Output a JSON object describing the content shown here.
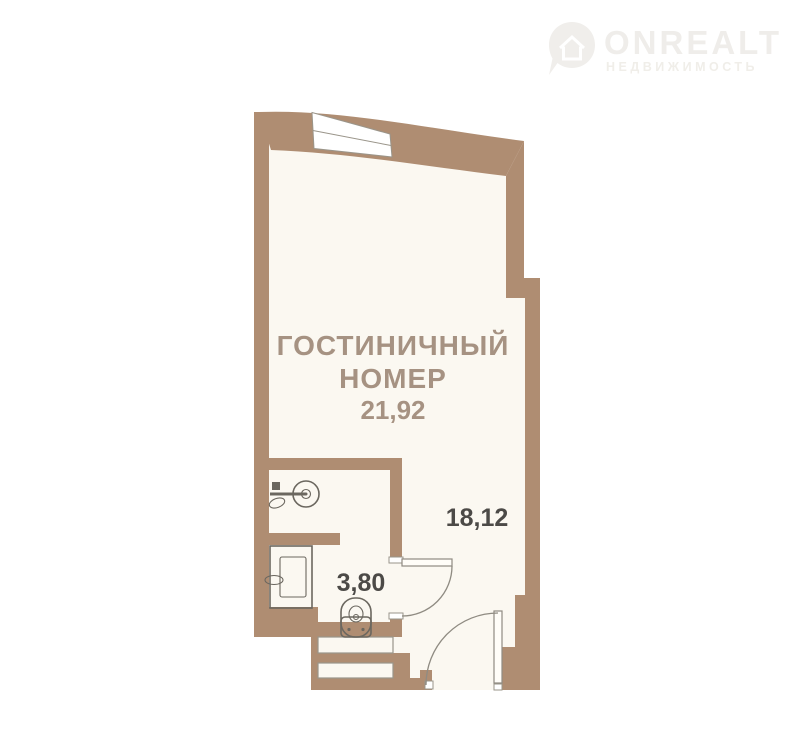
{
  "watermark": {
    "brand": "ONREALT",
    "subtitle": "НЕДВИЖИМОСТЬ",
    "icon": "onrealt-pin-house-icon"
  },
  "plan": {
    "room_label_line1": "ГОСТИНИЧНЫЙ",
    "room_label_line2": "НОМЕР",
    "room_total_area": "21,92",
    "main_room_area": "18,12",
    "bathroom_area": "3,80",
    "colors": {
      "wall": "#af8d72",
      "floor": "#fbf8f1",
      "room_label_text": "#a69282",
      "area_number_text": "#4c4a47",
      "fixture_line": "#6b675f",
      "watermark": "#efedea"
    },
    "fixtures": [
      "window",
      "entrance-door",
      "bathroom-door",
      "washbasin",
      "shower-tray",
      "toilet",
      "entry-steps"
    ]
  }
}
